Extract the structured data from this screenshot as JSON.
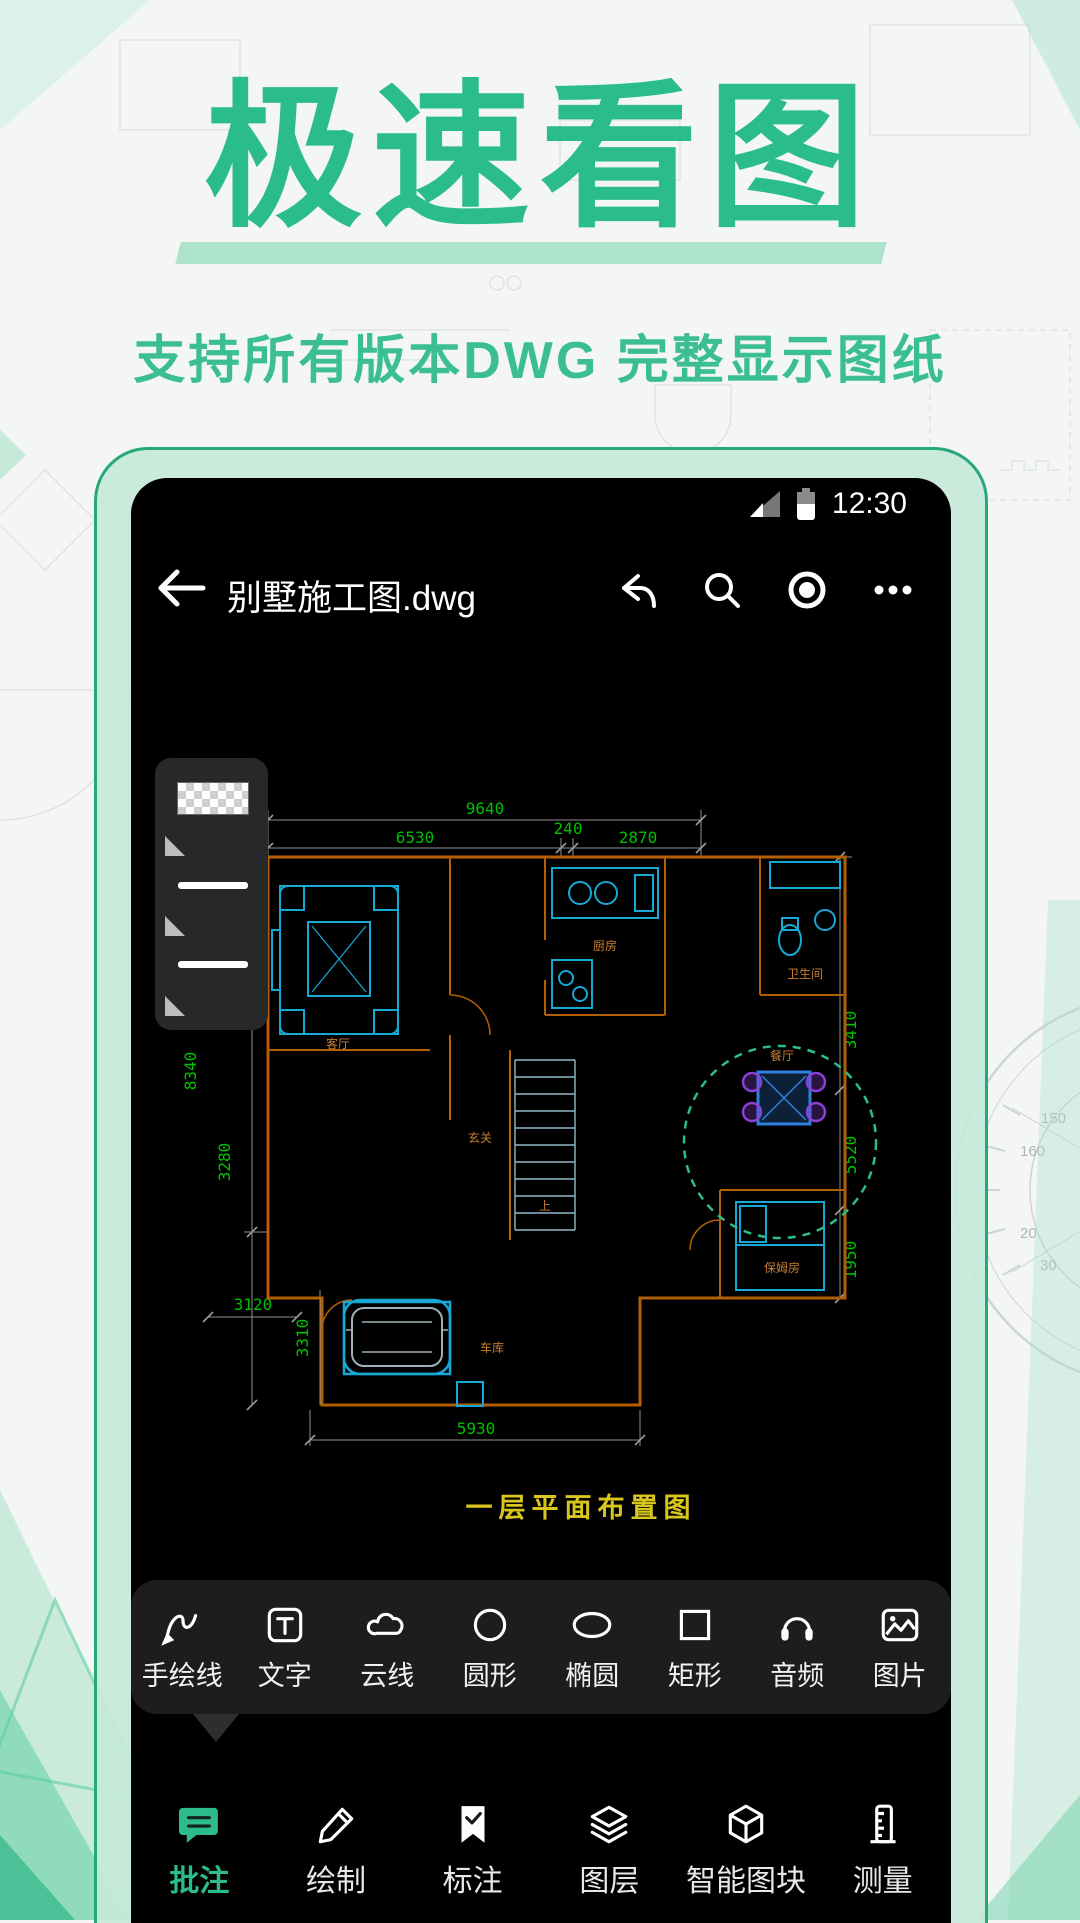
{
  "hero": {
    "title": "极速看图",
    "subtitle": "支持所有版本DWG 完整显示图纸"
  },
  "statusbar": {
    "time": "12:30"
  },
  "appbar": {
    "filename": "别墅施工图.dwg"
  },
  "drawing": {
    "caption": "一层平面布置图",
    "dims": {
      "total_width": "9640",
      "w1": "6530",
      "w2": "240",
      "w3": "2870",
      "left1": "8340",
      "left2": "3280",
      "bottom1": "3120",
      "bottom2": "3310",
      "bottom3": "5930",
      "right1": "3410",
      "right2": "5520",
      "right3": "1950"
    },
    "rooms": {
      "living": "客厅",
      "kitchen": "厨房",
      "bath": "卫生间",
      "dining": "餐厅",
      "entry": "玄关",
      "up": "上",
      "nanny": "保姆房",
      "garage": "车库"
    }
  },
  "toolbar": {
    "items": [
      {
        "icon": "freehand-line-icon",
        "label": "手绘线"
      },
      {
        "icon": "text-icon",
        "label": "文字"
      },
      {
        "icon": "cloud-line-icon",
        "label": "云线"
      },
      {
        "icon": "circle-icon",
        "label": "圆形"
      },
      {
        "icon": "ellipse-icon",
        "label": "椭圆"
      },
      {
        "icon": "rectangle-icon",
        "label": "矩形"
      },
      {
        "icon": "audio-icon",
        "label": "音频"
      },
      {
        "icon": "image-icon",
        "label": "图片"
      }
    ]
  },
  "tabbar": {
    "items": [
      {
        "icon": "annotate-icon",
        "label": "批注",
        "active": true
      },
      {
        "icon": "draw-icon",
        "label": "绘制"
      },
      {
        "icon": "dimension-icon",
        "label": "标注"
      },
      {
        "icon": "layers-icon",
        "label": "图层"
      },
      {
        "icon": "smart-block-icon",
        "label": "智能图块"
      },
      {
        "icon": "measure-icon",
        "label": "测量"
      }
    ]
  },
  "background": {
    "protractor_labels": {
      "a": "150",
      "b": "160",
      "c": "20",
      "d": "30"
    }
  },
  "colors": {
    "brand": "#2cbc8c",
    "subtitle": "#3cbf90",
    "dim_text": "#00c000",
    "wall": "#b45f04",
    "furniture": "#17a9d6",
    "selection": "#2f7fe0",
    "highlight_dashed": "#2dbd8a",
    "caption": "#d8c61d",
    "frame": "#27a87b"
  }
}
